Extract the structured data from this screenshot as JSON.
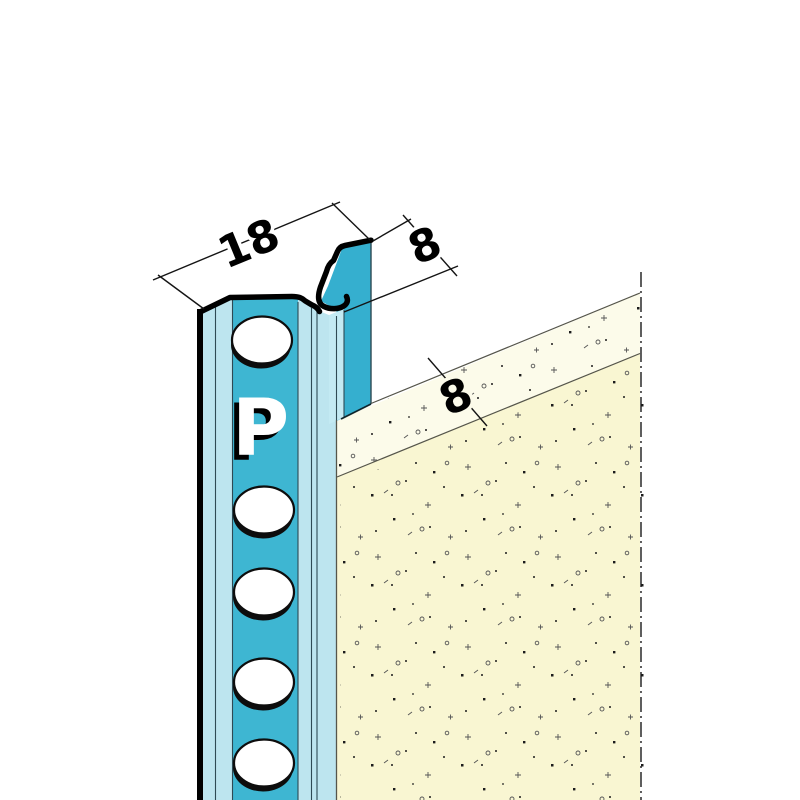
{
  "drawing": {
    "kind": "plaster-stop-profile-cross-section",
    "labels": {
      "profile_width": "18",
      "upstand_height": "8",
      "plaster_thickness": "8",
      "brand_mark": "P"
    }
  },
  "colors": {
    "background": "#ffffff",
    "outline": "#000000",
    "dim_line": "#141414",
    "section_line": "#1b1b1b",
    "thin_line": "#2e4a54",
    "plaster_edge_line": "#55554a",
    "profile_pale": "#bde5ef",
    "profile_teal": "#3eb6d2",
    "fin_teal": "#35afcf",
    "channel_pale": "#c3eaf3",
    "hole_fill": "#ffffff",
    "hole_shadow": "#0d0d0d",
    "plaster_top": "#fcfbea",
    "plaster_front": "#f9f6d2",
    "stipple_dark": "#1c1c1c",
    "stipple_light": "#555555"
  }
}
